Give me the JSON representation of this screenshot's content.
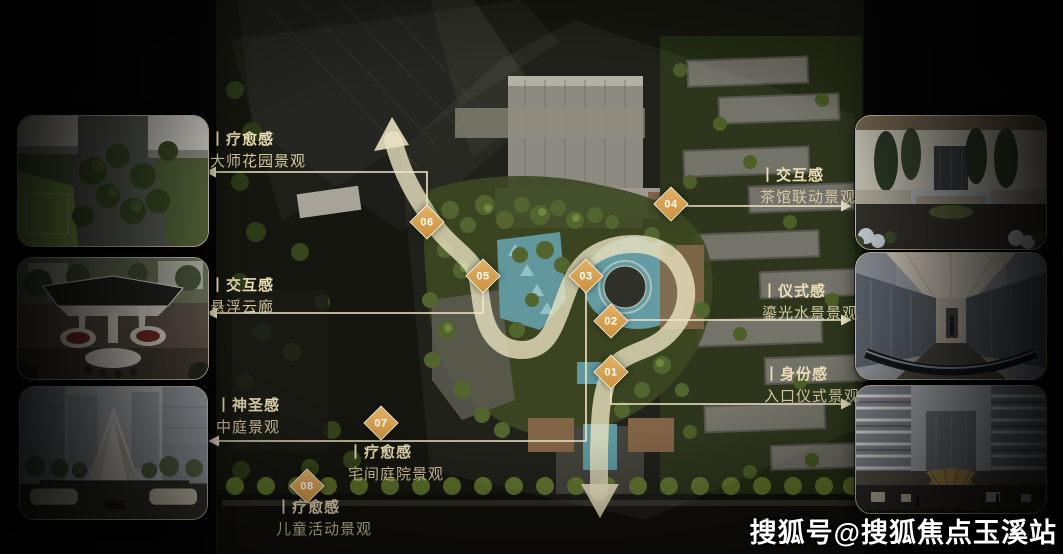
{
  "watermark": {
    "text": "搜狐号@搜狐焦点玉溪站"
  },
  "markers": [
    {
      "num": "01"
    },
    {
      "num": "02"
    },
    {
      "num": "03"
    },
    {
      "num": "04"
    },
    {
      "num": "05"
    },
    {
      "num": "06"
    },
    {
      "num": "07"
    },
    {
      "num": "08"
    }
  ],
  "callouts": {
    "left": [
      {
        "category": "丨疗愈感",
        "name": "大师花园景观"
      },
      {
        "category": "丨交互感",
        "name": "悬浮云廊"
      },
      {
        "category": "丨神圣感",
        "name": "中庭景观"
      }
    ],
    "bottom": [
      {
        "category": "丨疗愈感",
        "name": "宅间庭院景观"
      },
      {
        "category": "丨疗愈感",
        "name": "儿童活动景观"
      }
    ],
    "right": [
      {
        "category": "丨交互感",
        "name": "茶馆联动景观"
      },
      {
        "category": "丨仪式感",
        "name": "鎏光水景景观"
      },
      {
        "category": "丨身份感",
        "name": "入口仪式景观"
      }
    ]
  },
  "colors": {
    "background": "#050505",
    "marker_fill": "#d9a356",
    "line_cream": "#f0e7c8",
    "path_cream": "#e9e1c2",
    "label_title": "#ecdfb8",
    "label_sub": "#d6c9a2",
    "water_teal": "#5e98a0"
  }
}
